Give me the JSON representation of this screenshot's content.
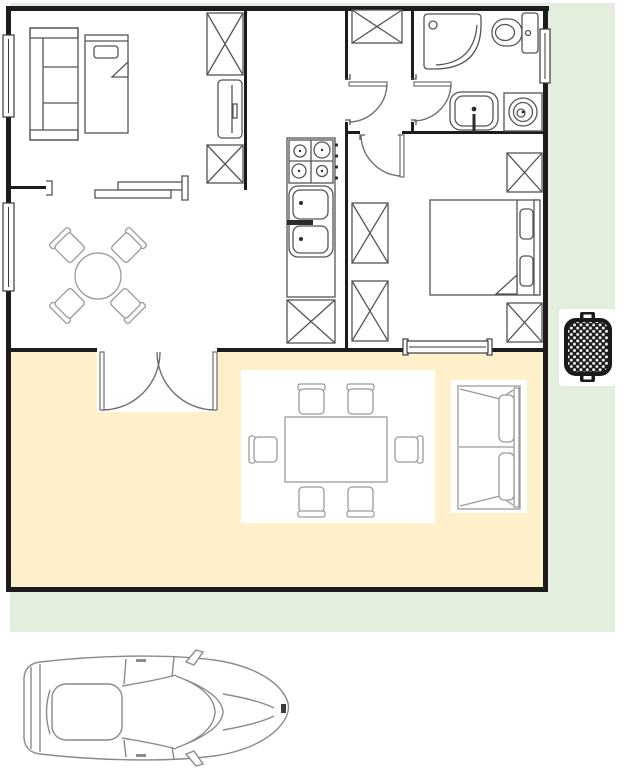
{
  "document": {
    "kind": "floor-plan",
    "title": "House floor plan with garden, terrace, barbecue and car",
    "visible_text": "none"
  },
  "colors": {
    "page_background": "#ffffff",
    "lawn": "#e3eedc",
    "patio": "#fdf0cb",
    "wall": "#1c1c1c",
    "room_floor": "#ffffff",
    "interior_furniture_line": "#555555",
    "outdoor_furniture_line": "#9a9a9a",
    "door_arc": "#6f6f6f",
    "grill_body": "#1a1a1a",
    "car_line": "#8a8a8a"
  },
  "areas": {
    "living_room": {
      "name": "living-dining room",
      "furniture": [
        "left-wall window",
        "left-wall window",
        "shelving cabinet",
        "daybed with pillow",
        "crossed storage box",
        "tv cabinet",
        "crossed storage box",
        "wall bracket",
        "sideboard shelves",
        "round table",
        "four diagonal chairs"
      ]
    },
    "kitchen": {
      "name": "kitchen",
      "furniture": [
        "stove with 4 burners and knobs",
        "double sink with faucet",
        "counter",
        "crossed cabinet"
      ]
    },
    "hallway": {
      "name": "hallway",
      "furniture": [
        "crossed closet"
      ],
      "doors": [
        "door to living area",
        "door to bathroom",
        "door to bedroom"
      ]
    },
    "bathroom": {
      "name": "bathroom",
      "furniture": [
        "corner shower",
        "toilet with tank",
        "washbasin",
        "washing machine",
        "right-wall window"
      ]
    },
    "bedroom": {
      "name": "bedroom",
      "furniture": [
        "double bed with two pillows",
        "crossed wardrobe",
        "crossed wardrobe",
        "crossed wardrobe",
        "crossed wardrobe",
        "bottom-wall window"
      ]
    },
    "patio": {
      "name": "terrace",
      "furniture": [
        "double french door",
        "rectangular table",
        "six chairs",
        "two-seat outdoor sofa"
      ]
    },
    "garden": {
      "name": "lawn",
      "objects": [
        "bbq grill"
      ]
    },
    "driveway": {
      "name": "driveway",
      "objects": [
        "car top view"
      ]
    }
  },
  "counts": {
    "round_table_chairs": 4,
    "patio_table_chairs": 6,
    "stove_burners": 4,
    "crossed_boxes_total": 8,
    "windows": 4,
    "interior_doors": 3
  }
}
